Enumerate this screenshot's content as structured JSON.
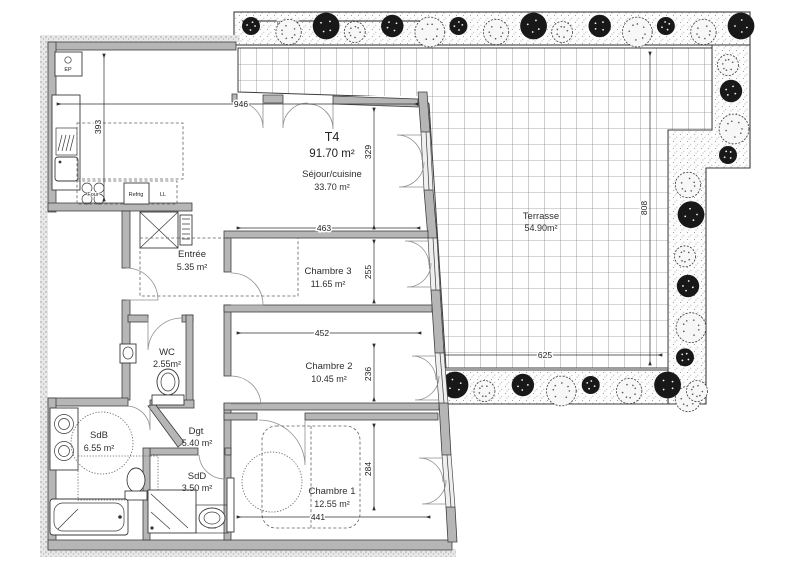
{
  "plan": {
    "title": {
      "type": "T4",
      "area": "91.70 m²"
    },
    "rooms": {
      "sejour": {
        "name": "Séjour/cuisine",
        "area": "33.70 m²"
      },
      "entree": {
        "name": "Entrée",
        "area": "5.35 m²"
      },
      "chambre3": {
        "name": "Chambre 3",
        "area": "11.65 m²"
      },
      "chambre2": {
        "name": "Chambre 2",
        "area": "10.45 m²"
      },
      "chambre1": {
        "name": "Chambre 1",
        "area": "12.55 m²"
      },
      "wc": {
        "name": "WC",
        "area": "2.55m²"
      },
      "sdb": {
        "name": "SdB",
        "area": "6.55 m²"
      },
      "sdd": {
        "name": "SdD",
        "area": "3.50 m²"
      },
      "dgt": {
        "name": "Dgt",
        "area": "5.40 m²"
      },
      "terrasse": {
        "name": "Terrasse",
        "area": "54.90m²"
      }
    },
    "dimensions": {
      "sejour_width": "946",
      "kitchen_depth": "393",
      "sejour_height": "329",
      "chambre3_width": "463",
      "chambre3_height": "255",
      "chambre2_width": "452",
      "chambre2_height": "236",
      "chambre1_width": "441",
      "chambre1_height": "284",
      "terrace_width": "625",
      "terrace_height": "808"
    },
    "annotations": {
      "pare_vue": "pare-vue",
      "ep": "EP",
      "four": "Four",
      "refrig": "Refrig",
      "ll": "LL"
    },
    "colors": {
      "wall_gray": "#b6b6b6",
      "line_dark": "#3c3c3c",
      "plant_dark": "#181818"
    }
  }
}
